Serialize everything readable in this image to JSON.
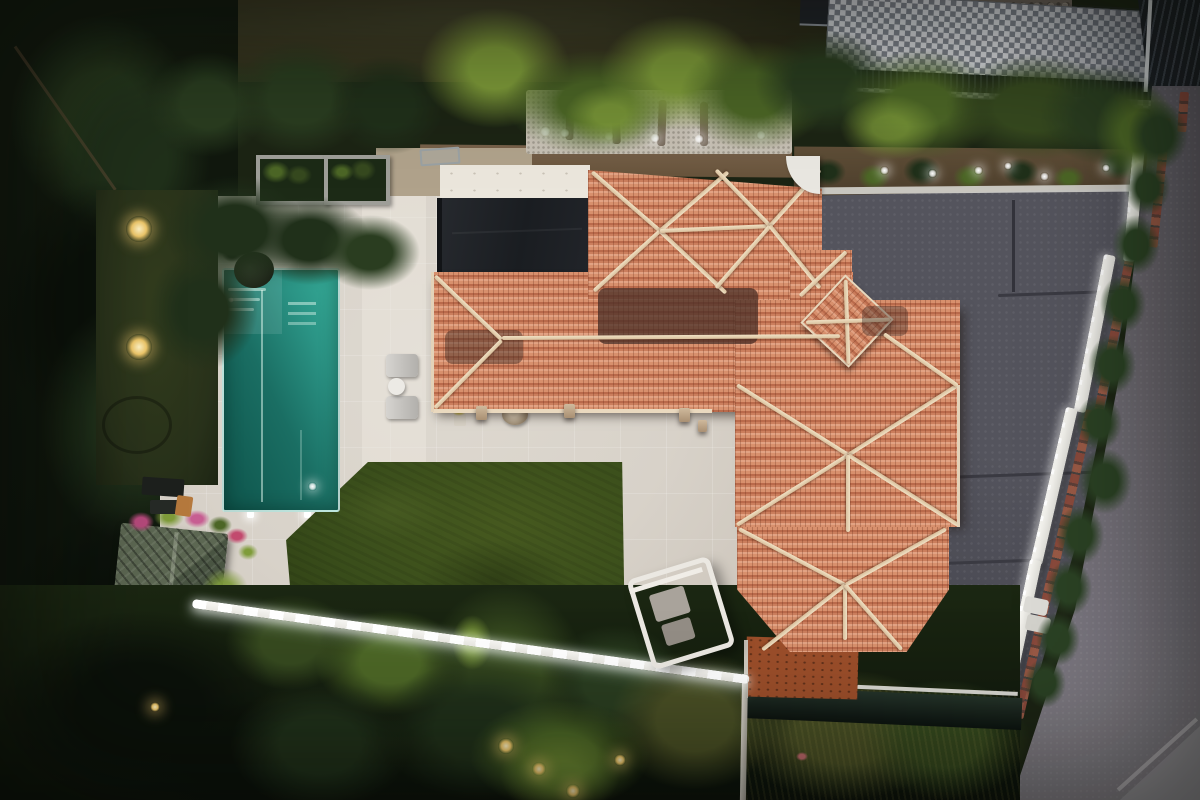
{
  "scene": {
    "label": "Aerial dusk drone view of a Mediterranean villa with terracotta hip roofs, rectangular pool, stone patio, lawn, grey driveway and bordering street"
  },
  "palette": {
    "patio_stone": "#d8d2c9",
    "pool_deep": "#0e544b",
    "pool_bright": "#36ad99",
    "lawn_green": "#3a4e1b",
    "roof_tile": "#cb7e5d",
    "roof_ridge_cream": "#ead9bf",
    "roof_dark_patch": "#5f4036",
    "black_canopy": "#202329",
    "flat_roof_white": "#ebe6dc",
    "driveway_grey": "#54545d",
    "street_asphalt": "#6e6a72",
    "boundary_wall_white": "#e3e2dc",
    "curb_red": "#82463a",
    "hedge_dark_green": "#2a3d20",
    "palm_yellow_green": "#7f9c3a",
    "forest_dark": "#11180f",
    "gravel_light": "#c6bfb3",
    "soil_brown": "#5f4e37",
    "shed_green_grey": "#535e49",
    "tarp_dark_green": "#1c2b20",
    "courtyard_rust": "#9b4e2a",
    "led_white": "#ffffff",
    "uplight_warm": "#eec76a",
    "neighbor_mosaic_light": "#d7d9dd",
    "neighbor_mosaic_dark": "#7e838c"
  },
  "objects": {
    "neighbor_lawn": {
      "label": "Neighbor lawn at top"
    },
    "neighbor_terrace": {
      "label": "Neighbor grey mosaic tiled terrace"
    },
    "neighbor_pergola": {
      "label": "Dark slatted pergola roof, top right corner"
    },
    "rock_wall": {
      "label": "Stone boulder wall"
    },
    "louvre_fence": {
      "label": "Dark slatted boundary fence"
    },
    "hedge_row": {
      "label": "Hedge row of conifers and palms along top boundary"
    },
    "gravel_bed": {
      "label": "White gravel bed with palm trunks and uplights"
    },
    "garden_bed": {
      "label": "Soil garden bed with shrubs and uplights"
    },
    "forest": {
      "label": "Dense dark trees on the west side"
    },
    "left_lawn": {
      "label": "Narrow dark side lawn with two warm garden lights"
    },
    "patio": {
      "label": "Light stone pool deck and patio"
    },
    "pool": {
      "label": "Rectangular swimming pool with steps and lap line"
    },
    "pool_roller": {
      "label": "Pool cover roller at pool head"
    },
    "sun_loungers": {
      "label": "Two sun loungers with round side table"
    },
    "planter_boxes": {
      "label": "Two square concrete planter boxes with shrubs"
    },
    "lawn": {
      "label": "Main manicured lawn"
    },
    "flat_roof": {
      "label": "White flat roof section"
    },
    "black_canopy": {
      "label": "Black canopy / awning roof section"
    },
    "villa_roof": {
      "label": "Terracotta tiled hip roof complex of the villa"
    },
    "roof_tower": {
      "label": "Small pyramidal roof tower rotated 45 degrees"
    },
    "porch_pillars": {
      "label": "Stone porch pillars under the eave"
    },
    "driveway": {
      "label": "Dark grey concrete driveway"
    },
    "street": {
      "label": "Asphalt street along the east side"
    },
    "sidewalk_corner": {
      "label": "Light sidewalk corner, bottom right"
    },
    "street_curb": {
      "label": "Red brick curb strip along the wall"
    },
    "boundary_wall": {
      "label": "White boundary wall with LED strip and hedge"
    },
    "wall_hedge": {
      "label": "Hedge bushes on top of boundary wall"
    },
    "wall_planters": {
      "label": "White planter boxes beside the wall"
    },
    "swing_bench": {
      "label": "White frame swing bench on patio"
    },
    "garden_shed": {
      "label": "Lattice-roof garden shed with flower planters"
    },
    "flower_planters": {
      "label": "Pink and green flowering planters by the shed"
    },
    "patio_items": {
      "label": "Outdoor kitchen items and wooden chair"
    },
    "led_path": {
      "label": "Bright LED strip along patio garden edge"
    },
    "drain_pipe": {
      "label": "Light drain channel running to bottom edge"
    },
    "courtyard": {
      "label": "Rust-brown entrance courtyard below roof"
    },
    "tarp": {
      "label": "Dark green screening tarp along lower boundary"
    },
    "bottom_vegetation": {
      "label": "Dense garden vegetation along bottom with warm lights"
    },
    "yellow_pot": {
      "label": "Yellow flowering pot on patio"
    },
    "fire_pit": {
      "label": "Round stone fire pit on patio"
    },
    "grey_bench": {
      "label": "Grey bench near gravel bed"
    },
    "white_arch": {
      "label": "White curved gate wall by driveway"
    }
  }
}
